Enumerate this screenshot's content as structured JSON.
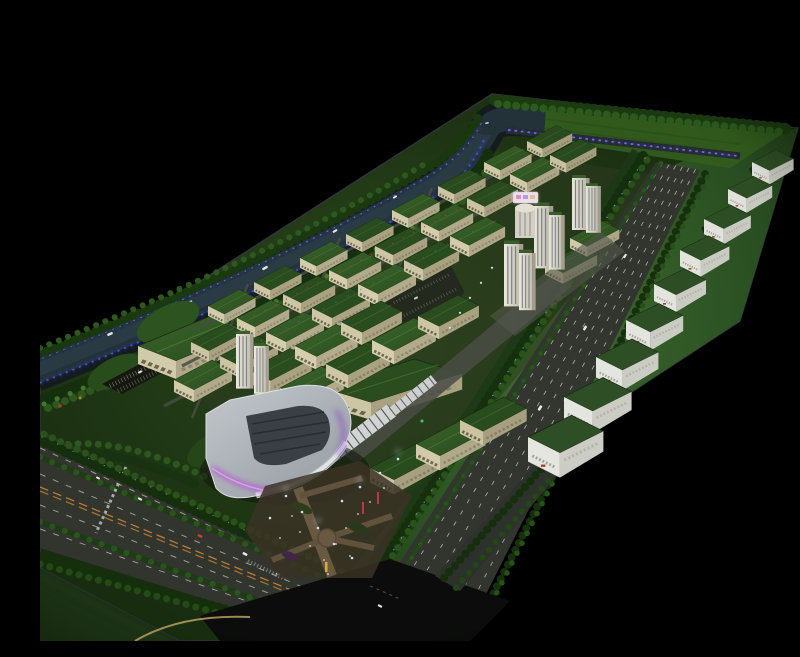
{
  "scene": {
    "type": "architectural scale model photograph",
    "caption": "Aerial night view of an illuminated architectural scale model of an industrial park on a black backdrop",
    "description": "Physical scale model photographed from above at an angle: a tree-lined river with blue LED-lit banks along the upper-left edge, a dense grid of cream factory blocks with dark green roofs, a cluster of white high-rise towers at center, a curved-roof exhibition hall with purple accent lighting and a glowing entry plaza at lower left, two wide boulevards with lane markings, and a row of white green-roofed warehouses on the eastern green field. Background is pure black."
  },
  "palette": {
    "background": "#000000",
    "field_green": "#2b5223",
    "lawn_green": "#35601f",
    "roof_green": "#2c4d20",
    "facade_cream": "#d6cfae",
    "warehouse_white": "#ecece6",
    "river_water": "#24333b",
    "led_blue": "#4a52ff",
    "accent_purple": "#b44fd9",
    "road_gray": "#33372f",
    "asphalt_dark": "#0b0c0b",
    "lane_marking_white": "#e9e9e9",
    "center_line_orange": "#c08038",
    "plaza_tan": "#6d5c44",
    "tree_dark_green": "#16300d",
    "tree_light_green": "#2d5a1f",
    "accent_red": "#c0392b",
    "accent_yellow": "#d8b33c",
    "pole_light_cyan": "#7fd8ff"
  },
  "inventory": {
    "river": {
      "label": "tree-lined river with LED-lit banks",
      "boats": 7
    },
    "factory_blocks": {
      "label": "green-roofed factory blocks",
      "count": 38
    },
    "warehouses": {
      "label": "white warehouse units along east field",
      "count": 9
    },
    "towers": {
      "label": "white high-rise slabs at center",
      "count": 9
    },
    "curved_building": {
      "label": "curved-roof exhibition hall with purple accent lighting"
    },
    "plaza": {
      "label": "entry plaza with glowing light poles",
      "light_poles": 15
    },
    "roads": {
      "label": "boulevards with lane markings",
      "main_roads": 2
    }
  }
}
